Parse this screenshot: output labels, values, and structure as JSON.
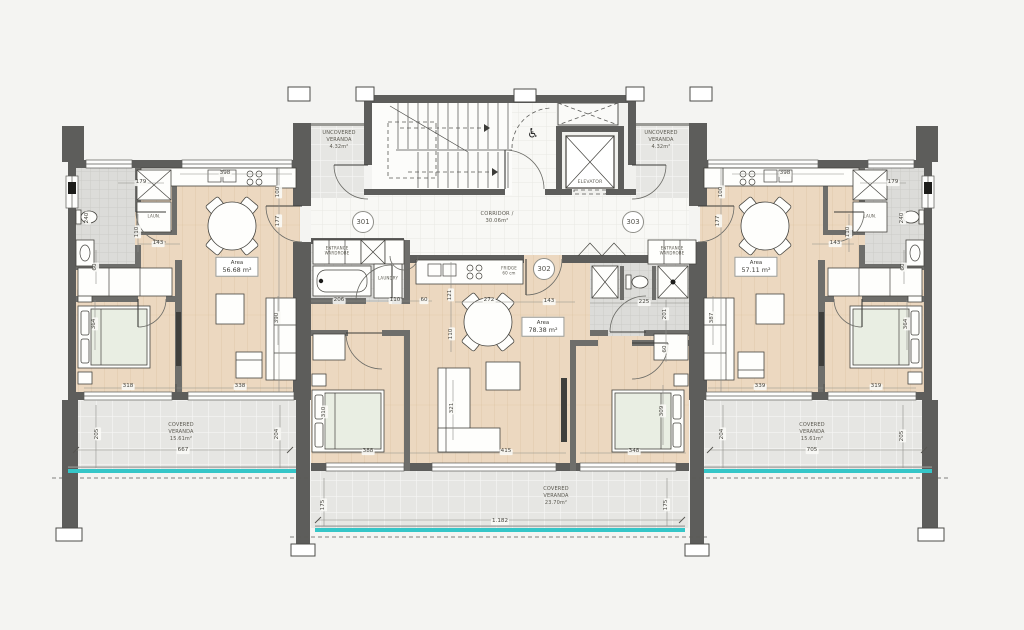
{
  "icons": {
    "wheelchair": "♿"
  },
  "colors": {
    "background": "#f4f4f2",
    "wall": "#5d5d5b",
    "wood_floor": "#ecd8c0",
    "veranda": "#e7e7e4",
    "tile": "#dcdcd9",
    "glass_balustrade_teal": "#35c6c8",
    "bed_mattress": "#e9eee3"
  },
  "units": [
    {
      "number": "301",
      "x": 363,
      "y": 222
    },
    {
      "number": "302",
      "x": 544,
      "y": 269
    },
    {
      "number": "303",
      "x": 633,
      "y": 222
    }
  ],
  "area_boxes": [
    {
      "label": "Area",
      "value": "56.68 m²",
      "x": 237,
      "y": 267
    },
    {
      "label": "Area",
      "value": "78.38 m²",
      "x": 543,
      "y": 327
    },
    {
      "label": "Area",
      "value": "57.11 m²",
      "x": 756,
      "y": 267
    }
  ],
  "zones": [
    {
      "name": "uncovered-veranda-left",
      "lines": [
        "UNCOVERED",
        "VERANDA",
        "4.32m²"
      ],
      "x": 339,
      "y": 140,
      "fs": 5.0
    },
    {
      "name": "uncovered-veranda-right",
      "lines": [
        "UNCOVERED",
        "VERANDA",
        "4.32m²"
      ],
      "x": 661,
      "y": 140,
      "fs": 5.0
    },
    {
      "name": "corridor",
      "lines": [
        "CORRIDOR /",
        "30.06m²"
      ],
      "x": 497,
      "y": 218,
      "fs": 5.2
    },
    {
      "name": "elevator",
      "lines": [
        "ELEVATOR"
      ],
      "x": 590,
      "y": 183,
      "fs": 4.6
    },
    {
      "name": "entrance-wardrobe-302",
      "lines": [
        "ENTRANCE",
        "WARDROBE"
      ],
      "x": 337,
      "y": 251,
      "fs": 4.0
    },
    {
      "name": "entrance-wardrobe-303",
      "lines": [
        "ENTRANCE",
        "WARDROBE"
      ],
      "x": 672,
      "y": 251,
      "fs": 4.0
    },
    {
      "name": "laundry-301",
      "lines": [
        "LAUN."
      ],
      "x": 154,
      "y": 216,
      "fs": 4.0
    },
    {
      "name": "laundry-302",
      "lines": [
        "LAUNDRY"
      ],
      "x": 388,
      "y": 278,
      "fs": 4.0
    },
    {
      "name": "laundry-303",
      "lines": [
        "LAUN."
      ],
      "x": 870,
      "y": 216,
      "fs": 4.0
    },
    {
      "name": "fridge-302",
      "lines": [
        "FRIDGE",
        "60 cm"
      ],
      "x": 509,
      "y": 271,
      "fs": 4.0
    },
    {
      "name": "covered-veranda-left",
      "lines": [
        "COVERED",
        "VERANDA",
        "15.61m²"
      ],
      "x": 181,
      "y": 432,
      "fs": 5.0
    },
    {
      "name": "covered-veranda-right",
      "lines": [
        "COVERED",
        "VERANDA",
        "15.61m²"
      ],
      "x": 812,
      "y": 432,
      "fs": 5.0
    },
    {
      "name": "covered-veranda-center",
      "lines": [
        "COVERED",
        "VERANDA",
        "23.70m²"
      ],
      "x": 556,
      "y": 496,
      "fs": 5.0
    }
  ],
  "dims": [
    {
      "t": "179",
      "x": 141,
      "y": 183
    },
    {
      "t": "398",
      "x": 225,
      "y": 174
    },
    {
      "t": "240",
      "x": 88,
      "y": 218,
      "v": 1
    },
    {
      "t": "110",
      "x": 138,
      "y": 232,
      "v": 1
    },
    {
      "t": "143",
      "x": 158,
      "y": 244
    },
    {
      "t": "100",
      "x": 279,
      "y": 192,
      "v": 1
    },
    {
      "t": "177",
      "x": 279,
      "y": 221,
      "v": 1
    },
    {
      "t": "60",
      "x": 96,
      "y": 267,
      "v": 1
    },
    {
      "t": "364",
      "x": 95,
      "y": 324,
      "v": 1
    },
    {
      "t": "390",
      "x": 278,
      "y": 318,
      "v": 1
    },
    {
      "t": "318",
      "x": 128,
      "y": 387
    },
    {
      "t": "338",
      "x": 240,
      "y": 387
    },
    {
      "t": "205",
      "x": 98,
      "y": 434,
      "v": 1
    },
    {
      "t": "204",
      "x": 278,
      "y": 434,
      "v": 1
    },
    {
      "t": "667",
      "x": 183,
      "y": 451
    },
    {
      "t": "206",
      "x": 339,
      "y": 301
    },
    {
      "t": "110",
      "x": 395,
      "y": 301
    },
    {
      "t": "60",
      "x": 424,
      "y": 301
    },
    {
      "t": "121",
      "x": 451,
      "y": 295,
      "v": 1
    },
    {
      "t": "110",
      "x": 452,
      "y": 334,
      "v": 1
    },
    {
      "t": "272",
      "x": 489,
      "y": 301
    },
    {
      "t": "143",
      "x": 549,
      "y": 302
    },
    {
      "t": "225",
      "x": 644,
      "y": 303
    },
    {
      "t": "201",
      "x": 666,
      "y": 314,
      "v": 1
    },
    {
      "t": "60",
      "x": 666,
      "y": 349,
      "v": 1
    },
    {
      "t": "310",
      "x": 325,
      "y": 412,
      "v": 1
    },
    {
      "t": "388",
      "x": 368,
      "y": 452
    },
    {
      "t": "321",
      "x": 453,
      "y": 408,
      "v": 1
    },
    {
      "t": "415",
      "x": 506,
      "y": 452
    },
    {
      "t": "348",
      "x": 634,
      "y": 452
    },
    {
      "t": "309",
      "x": 663,
      "y": 411,
      "v": 1
    },
    {
      "t": "175",
      "x": 324,
      "y": 505,
      "v": 1
    },
    {
      "t": "175",
      "x": 667,
      "y": 505,
      "v": 1
    },
    {
      "t": "1.182",
      "x": 500,
      "y": 522
    },
    {
      "t": "179",
      "x": 893,
      "y": 183
    },
    {
      "t": "398",
      "x": 785,
      "y": 174
    },
    {
      "t": "240",
      "x": 903,
      "y": 218,
      "v": 1
    },
    {
      "t": "110",
      "x": 849,
      "y": 232,
      "v": 1
    },
    {
      "t": "143",
      "x": 835,
      "y": 244
    },
    {
      "t": "100",
      "x": 722,
      "y": 192,
      "v": 1
    },
    {
      "t": "177",
      "x": 719,
      "y": 221,
      "v": 1
    },
    {
      "t": "60",
      "x": 904,
      "y": 267,
      "v": 1
    },
    {
      "t": "364",
      "x": 907,
      "y": 324,
      "v": 1
    },
    {
      "t": "387",
      "x": 713,
      "y": 318,
      "v": 1
    },
    {
      "t": "339",
      "x": 760,
      "y": 387
    },
    {
      "t": "319",
      "x": 876,
      "y": 387
    },
    {
      "t": "204",
      "x": 723,
      "y": 434,
      "v": 1
    },
    {
      "t": "205",
      "x": 903,
      "y": 436,
      "v": 1
    },
    {
      "t": "705",
      "x": 812,
      "y": 451
    }
  ]
}
